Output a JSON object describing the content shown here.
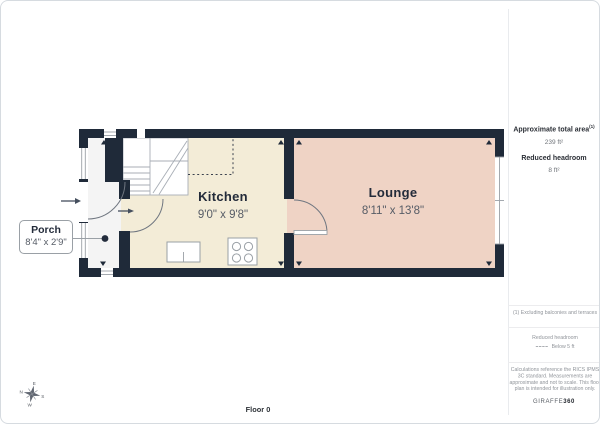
{
  "page": {
    "floor_label": "Floor 0"
  },
  "plan": {
    "rooms": [
      {
        "name": "Kitchen",
        "dimensions": "9'0\" x 9'8\""
      },
      {
        "name": "Lounge",
        "dimensions": "8'11\" x 13'8\""
      }
    ],
    "callout": {
      "name": "Porch",
      "dimensions": "8'4\" x 2'9\""
    },
    "compass": {
      "n": "N",
      "e": "E",
      "s": "S",
      "w": "W"
    }
  },
  "sidebar": {
    "total_area_label": "Approximate total area",
    "total_area_note_ref": "(1)",
    "total_area_value": "239 ft²",
    "reduced_headroom_label": "Reduced headroom",
    "reduced_headroom_value": "8 ft²",
    "footnote": "(1) Excluding balconies and terraces",
    "legend_title": "Reduced headroom",
    "legend_label": "Below 5 ft",
    "disclaimer": "Calculations reference the RICS IPMS 3C standard. Measurements are approximate and not to scale. This floor plan is intended for illustration only.",
    "brand_name": "GIRAFFE",
    "brand_suffix": "360"
  },
  "colors": {
    "wall": "#1f2a39",
    "kitchen_floor": "#f3ecd7",
    "lounge_floor": "#efd3c5",
    "porch_floor": "#f4f4f4",
    "page_border": "#d6dbe0"
  }
}
